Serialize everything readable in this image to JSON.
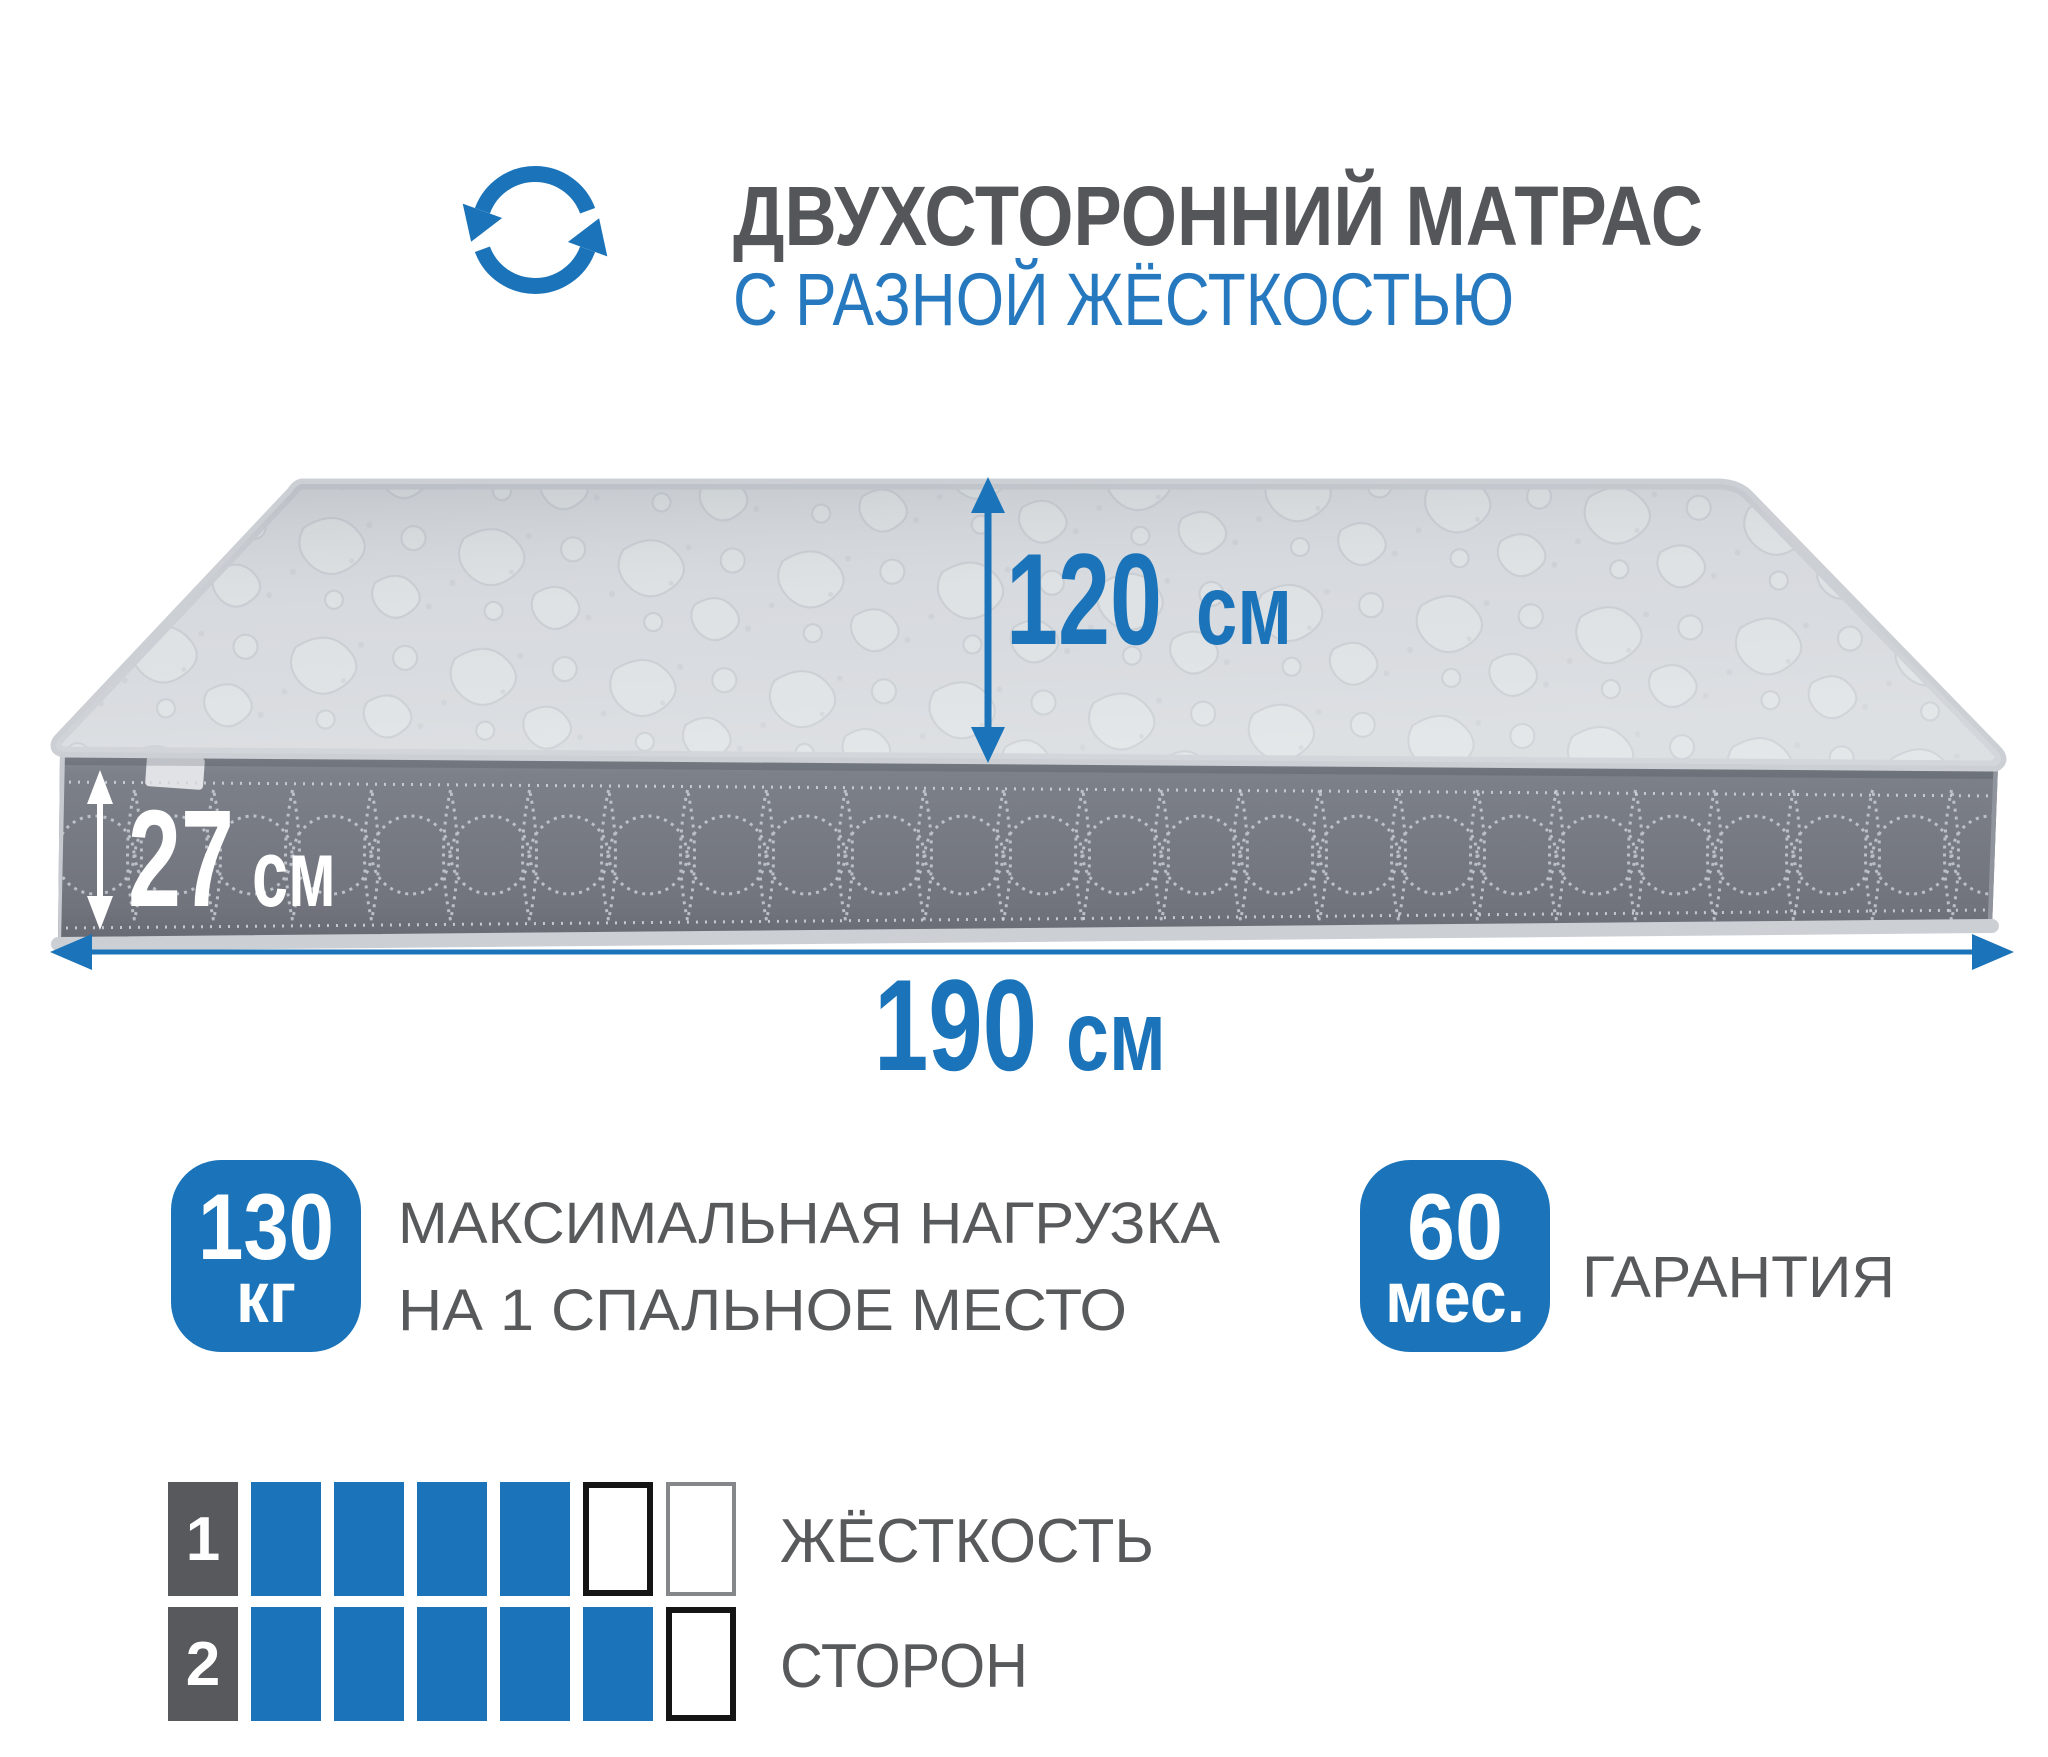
{
  "colors": {
    "accent": "#1b74b9",
    "subBlue": "#2779bf",
    "titleGray": "#545659",
    "textGray": "#58595b",
    "cellDark": "#58595c",
    "sideGray": "#787c84",
    "topGray": "#d8dbdf",
    "piping": "#ccd0d5"
  },
  "header": {
    "title": "ДВУХСТОРОННИЙ МАТРАС",
    "subtitle": "С РАЗНОЙ ЖЁСТКОСТЬЮ"
  },
  "dimensions": {
    "depth": {
      "value": "120",
      "unit": "см"
    },
    "height": {
      "value": "27",
      "unit": "см"
    },
    "length": {
      "value": "190",
      "unit": "см"
    }
  },
  "features": {
    "load": {
      "value": "130",
      "unit": "кг",
      "line1": "МАКСИМАЛЬНАЯ НАГРУЗКА",
      "line2": "НА 1 СПАЛЬНОЕ МЕСТО"
    },
    "warranty": {
      "value": "60",
      "unit": "мес.",
      "label": "ГАРАНТИЯ"
    }
  },
  "firmness": {
    "label_line1": "ЖЁСТКОСТЬ",
    "label_line2": "СТОРОН",
    "rows": [
      {
        "side": "1",
        "cells": [
          "filled",
          "filled",
          "filled",
          "filled",
          "empty-strong",
          "empty-weak"
        ]
      },
      {
        "side": "2",
        "cells": [
          "filled",
          "filled",
          "filled",
          "filled",
          "filled",
          "empty-strong"
        ]
      }
    ]
  }
}
